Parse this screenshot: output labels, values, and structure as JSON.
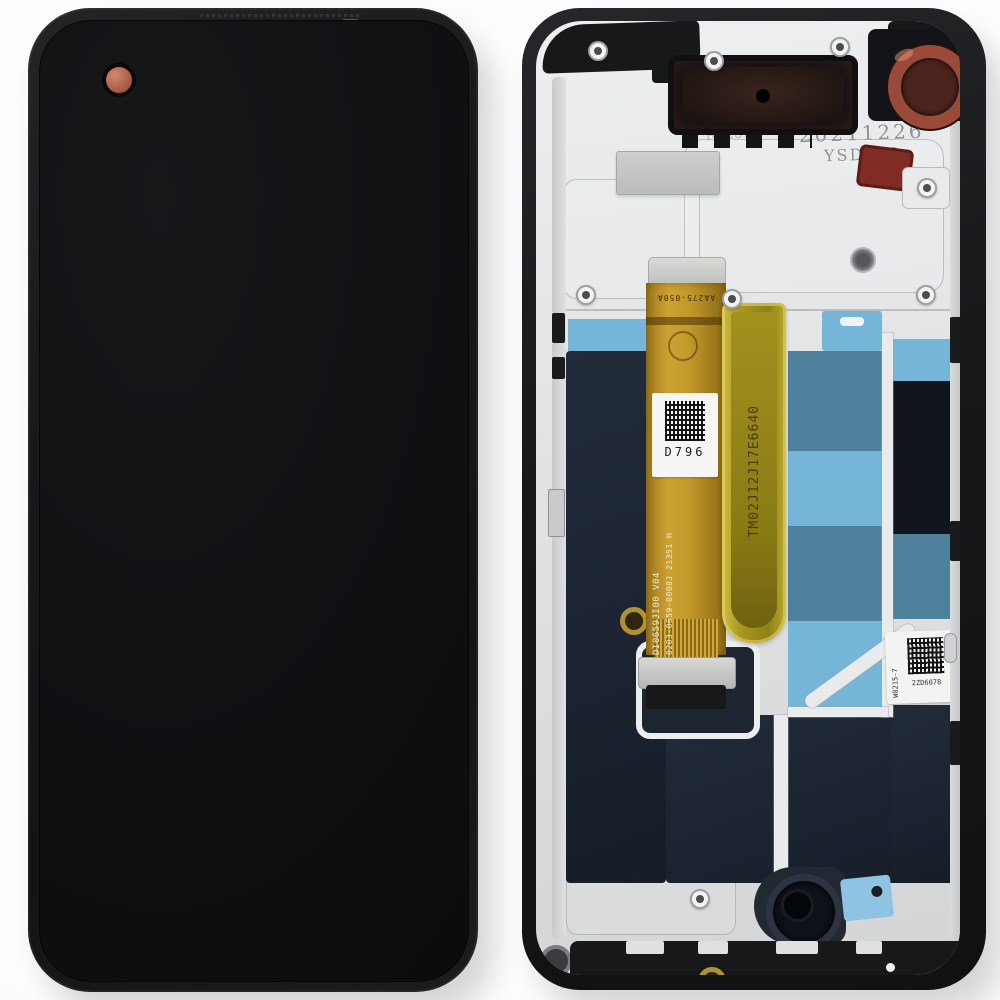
{
  "scene": {
    "subject": "Smartphone LCD display assembly replacement part, front glass view and rear chassis view",
    "background_color": "#fbfbfc"
  },
  "front": {
    "screen_color": "#101013",
    "bezel_color": "#1a1a1c",
    "punch_hole_camera_color": "#b16049"
  },
  "rear": {
    "frame_color": "#161719",
    "chassis_color": "#e2e3e5",
    "display_back_color": "#1b2330",
    "tape_light_blue": "#74b5d8",
    "tape_teal": "#4f819c",
    "flex_gold": "#c2982a",
    "kapton_yellow": "#a8971f",
    "mold_stamp": {
      "line1": "AB257 W",
      "line2": "RJL52"
    },
    "date_stamp": {
      "line1": "20211226",
      "line2": "YSD008"
    },
    "flex": {
      "top_marking": "AA275-050A",
      "label_code": "D796",
      "marking_line1": "DI0659JI00  V04",
      "marking_line2": "0203-0659-0000J 21351 H",
      "kapton_marking": "TM02J12J17E6640"
    },
    "side_label": {
      "vertical_text": "W0215-7",
      "code_text": "2ZD6078"
    }
  }
}
